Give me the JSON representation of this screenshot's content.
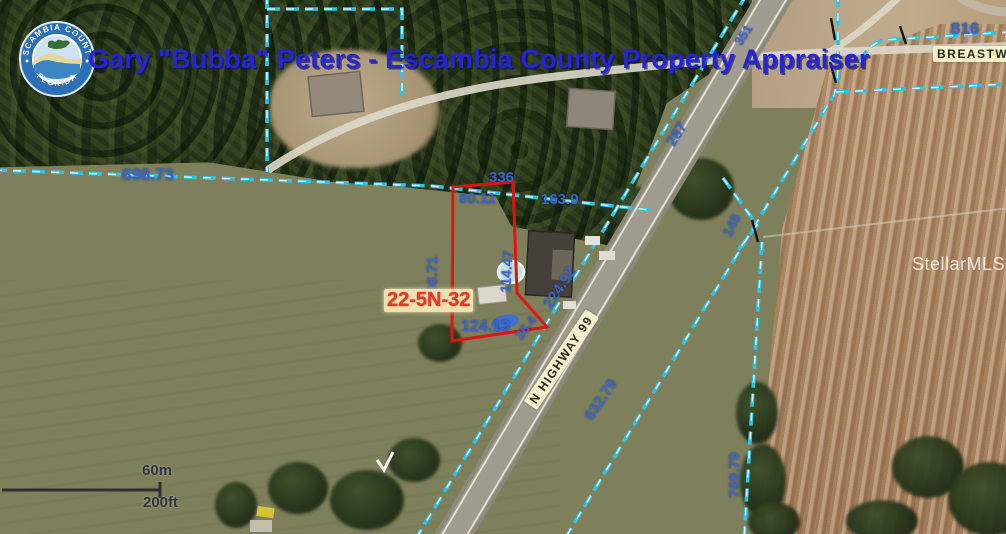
{
  "branding": {
    "title": "Gary \"Bubba\" Peters - Escambia County Property Appraiser",
    "logo_top": "ESCAMBIA COUNTY",
    "logo_bottom": "FLORIDA"
  },
  "watermark": "StellarMLS",
  "parcel": {
    "id_label": "22-5N-32"
  },
  "roads": {
    "highway": "N HIGHWAY 99",
    "cross_street": "BREASTWO"
  },
  "dimensions": {
    "d898": "898.73",
    "d336": "336",
    "d80": "80.11",
    "d163": "163.9",
    "d287": "287",
    "d351": "351",
    "d816": "816",
    "d148": "148",
    "d208": "208.71",
    "d114": "114.47",
    "d26": "26.4",
    "d124": "124.13",
    "d224": "224.92",
    "d632": "632.79",
    "d769": "769.79"
  },
  "scale_bar": {
    "metric": "60m",
    "imperial": "200ft"
  }
}
